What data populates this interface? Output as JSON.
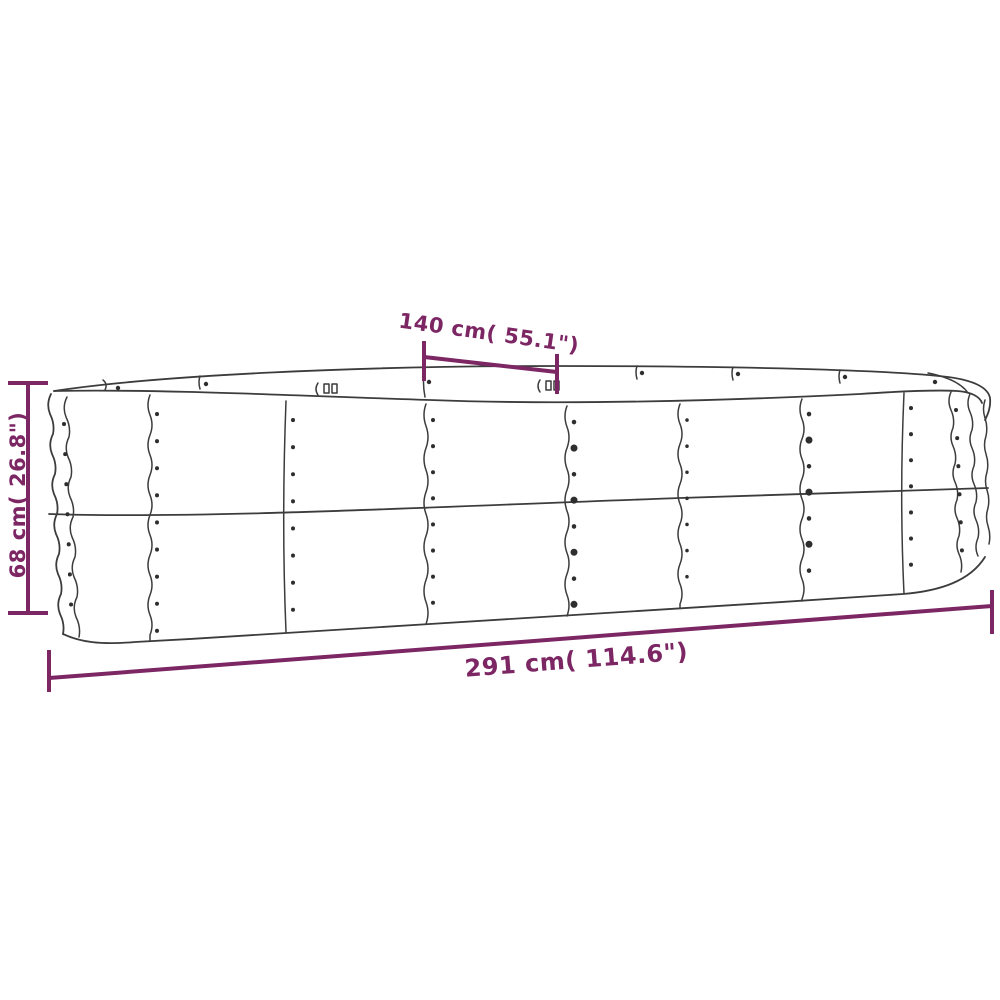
{
  "diagram": {
    "background": "#ffffff",
    "accent_color": "#7c2664",
    "line_art_color": "#3c3c3c",
    "product": "Oval corrugated-metal raised garden bed (technical line drawing with dimension callouts)",
    "labels": {
      "top_width": "140 cm( 55.1\")",
      "height": "68 cm( 26.8\")",
      "length": "291 cm( 114.6\")"
    },
    "values": {
      "top_width_cm": 140,
      "top_width_in": 55.1,
      "height_cm": 68,
      "height_in": 26.8,
      "length_cm": 291,
      "length_in": 114.6
    }
  }
}
